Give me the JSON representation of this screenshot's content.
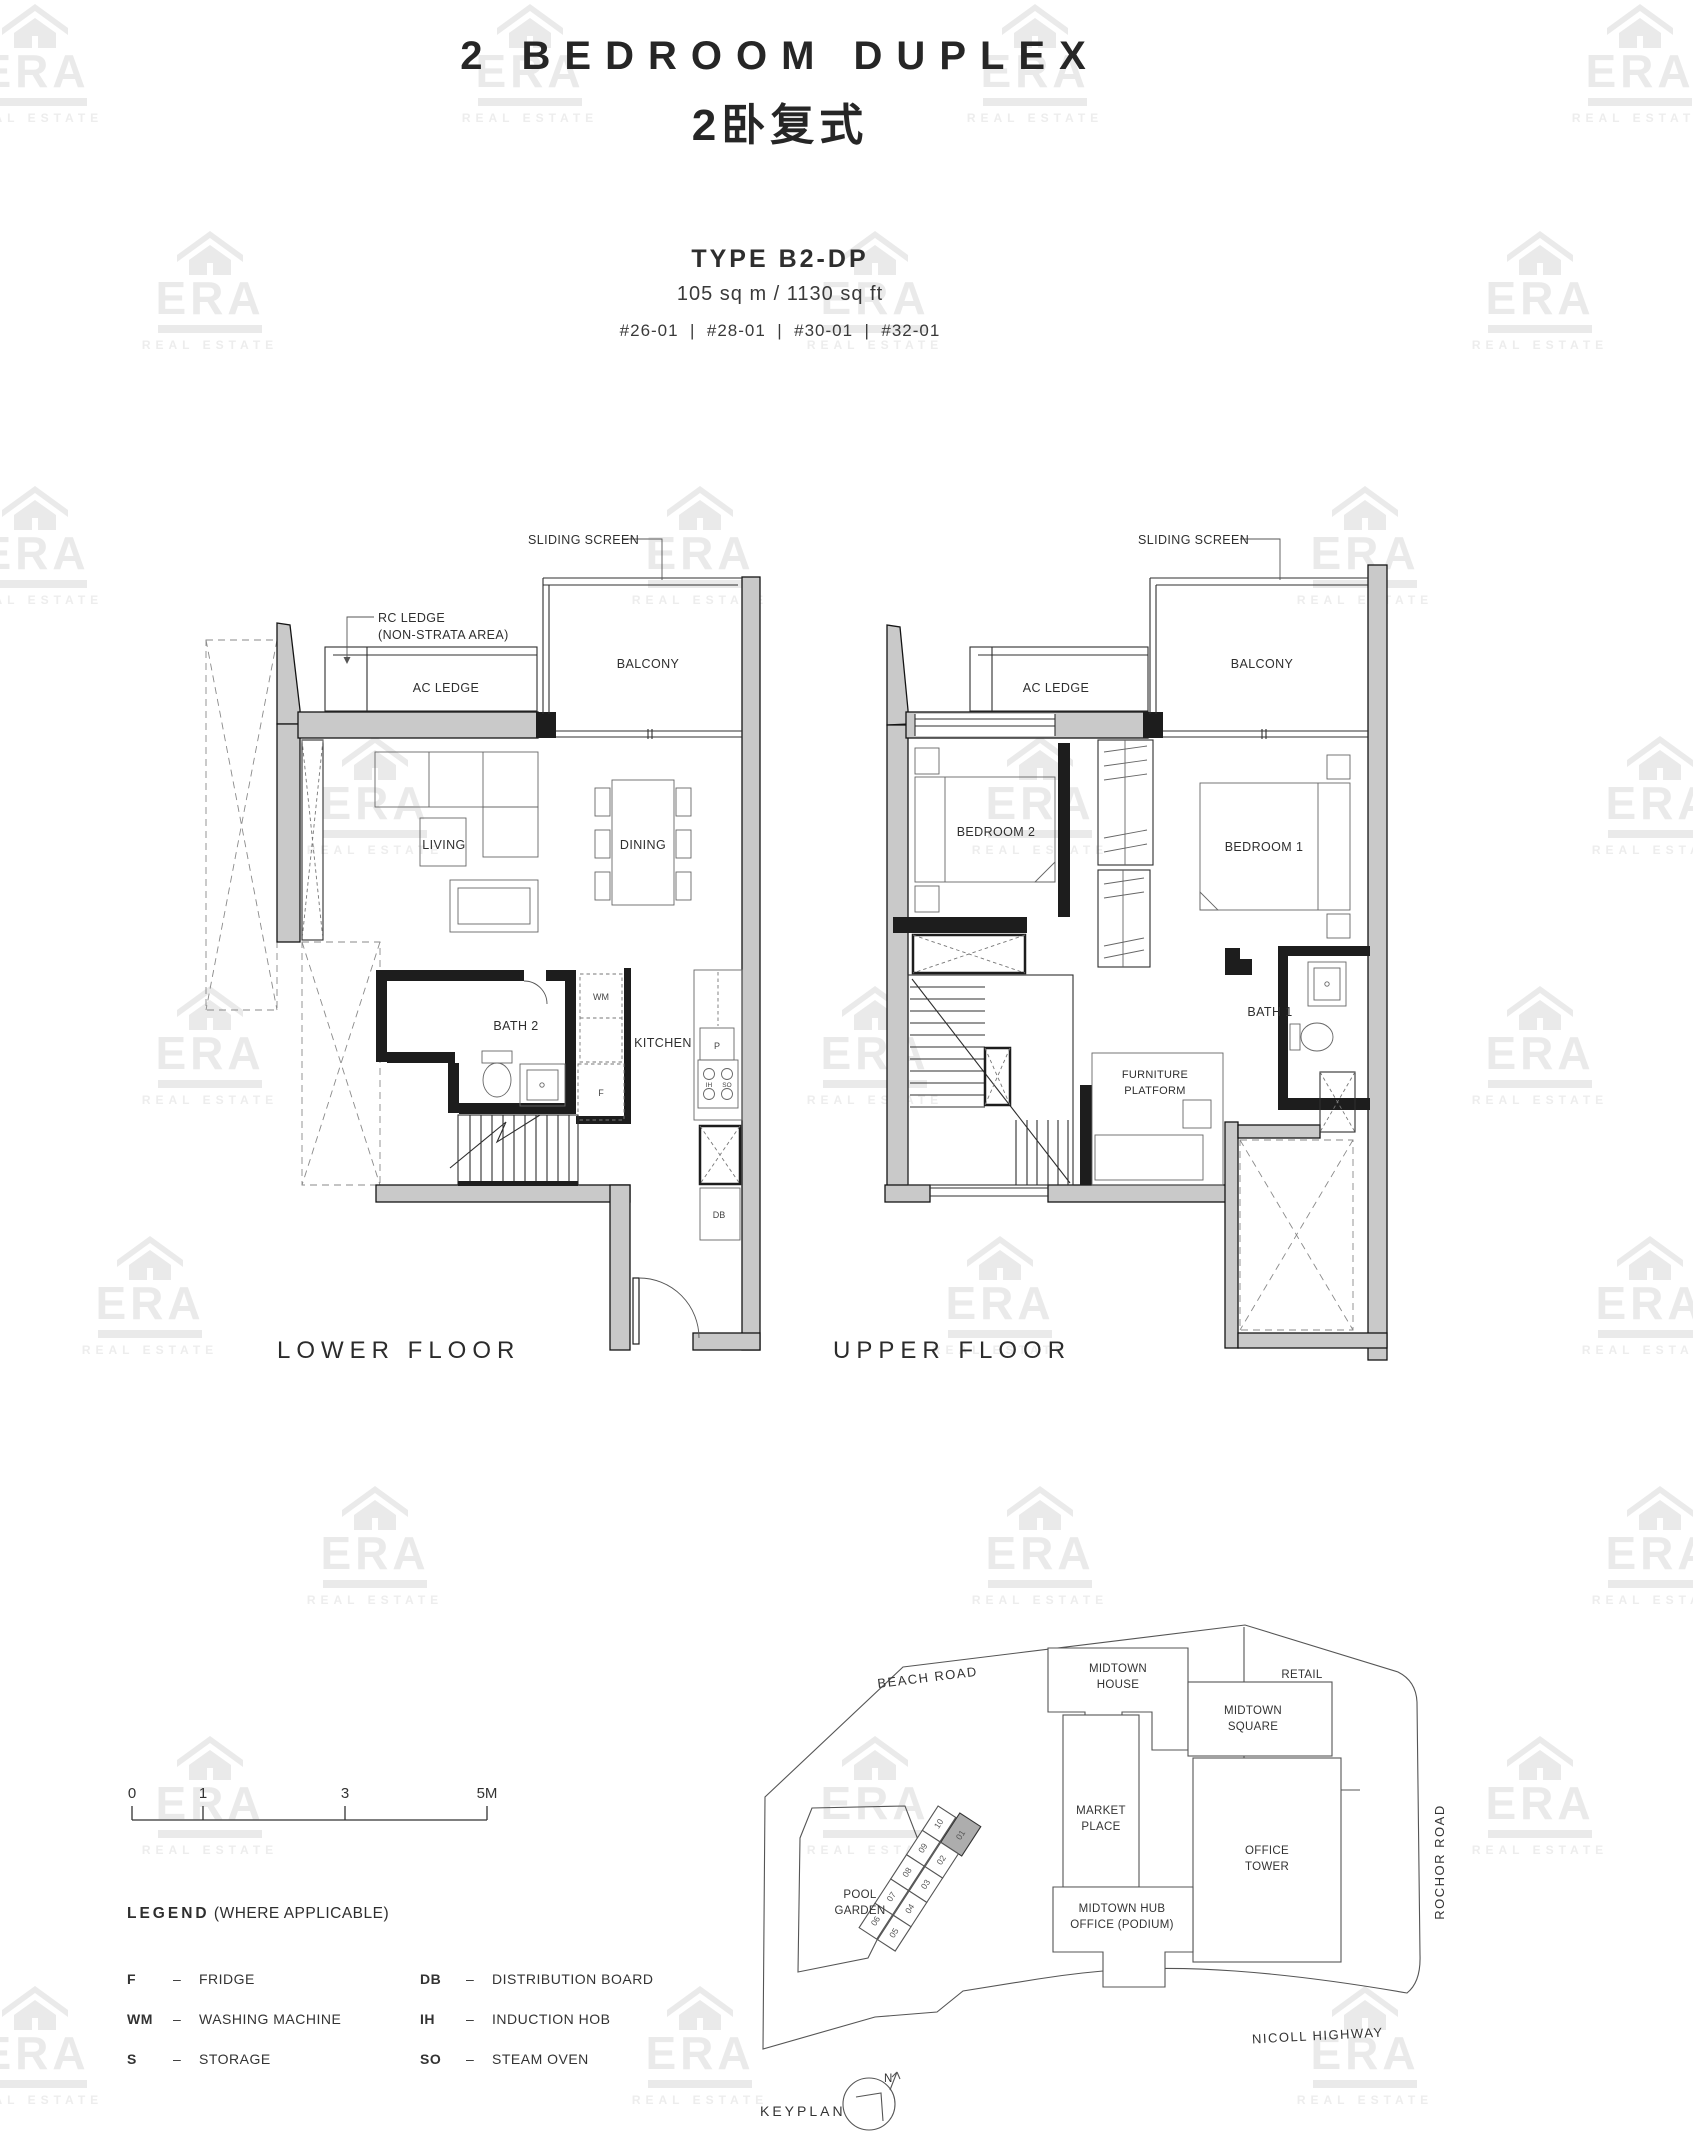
{
  "header": {
    "title": "2 BEDROOM DUPLEX",
    "subtitle_cn": "2卧复式",
    "type": "TYPE B2-DP",
    "area": "105 sq m / 1130 sq ft",
    "units": "#26-01  |  #28-01  |  #30-01  |  #32-01"
  },
  "watermark": {
    "brand": "ERA",
    "tagline": "REAL ESTATE"
  },
  "plans": {
    "lower": {
      "title": "LOWER FLOOR",
      "labels": {
        "sliding_screen": "SLIDING SCREEN",
        "rc_ledge_line1": "RC LEDGE",
        "rc_ledge_line2": "(NON-STRATA AREA)",
        "ac_ledge": "AC LEDGE",
        "balcony": "BALCONY",
        "living": "LIVING",
        "dining": "DINING",
        "bath2": "BATH 2",
        "kitchen": "KITCHEN",
        "wm": "WM",
        "fridge": "F",
        "pantry": "P",
        "ih": "IH",
        "so": "SO",
        "db": "DB"
      }
    },
    "upper": {
      "title": "UPPER FLOOR",
      "labels": {
        "sliding_screen": "SLIDING SCREEN",
        "ac_ledge": "AC LEDGE",
        "balcony": "BALCONY",
        "bedroom2": "BEDROOM 2",
        "bedroom1": "BEDROOM 1",
        "bath1": "BATH 1",
        "furniture_line1": "FURNITURE",
        "furniture_line2": "PLATFORM"
      }
    }
  },
  "scalebar": {
    "t0": "0",
    "t1": "1",
    "t3": "3",
    "t5": "5M"
  },
  "legend": {
    "title": "LEGEND",
    "subtitle": "(WHERE APPLICABLE)",
    "col1": [
      {
        "abbr": "F",
        "sep": "–",
        "label": "FRIDGE"
      },
      {
        "abbr": "WM",
        "sep": "–",
        "label": "WASHING MACHINE"
      },
      {
        "abbr": "S",
        "sep": "–",
        "label": "STORAGE"
      }
    ],
    "col2": [
      {
        "abbr": "DB",
        "sep": "–",
        "label": "DISTRIBUTION BOARD"
      },
      {
        "abbr": "IH",
        "sep": "–",
        "label": "INDUCTION HOB"
      },
      {
        "abbr": "SO",
        "sep": "–",
        "label": "STEAM OVEN"
      }
    ]
  },
  "keyplan": {
    "label": "KEYPLAN",
    "north": "N",
    "roads": {
      "beach": "BEACH ROAD",
      "rochor": "ROCHOR ROAD",
      "nicoll": "NICOLL HIGHWAY"
    },
    "buildings": {
      "midtown_house": [
        "MIDTOWN",
        "HOUSE"
      ],
      "retail": "RETAIL",
      "midtown_square": [
        "MIDTOWN",
        "SQUARE"
      ],
      "market_place": [
        "MARKET",
        "PLACE"
      ],
      "office_tower": [
        "OFFICE",
        "TOWER"
      ],
      "midtown_hub": [
        "MIDTOWN HUB",
        "OFFICE (PODIUM)"
      ],
      "pool_garden": [
        "POOL",
        "GARDEN"
      ]
    },
    "units": [
      "01",
      "02",
      "03",
      "04",
      "05",
      "06",
      "07",
      "08",
      "09",
      "10"
    ]
  }
}
